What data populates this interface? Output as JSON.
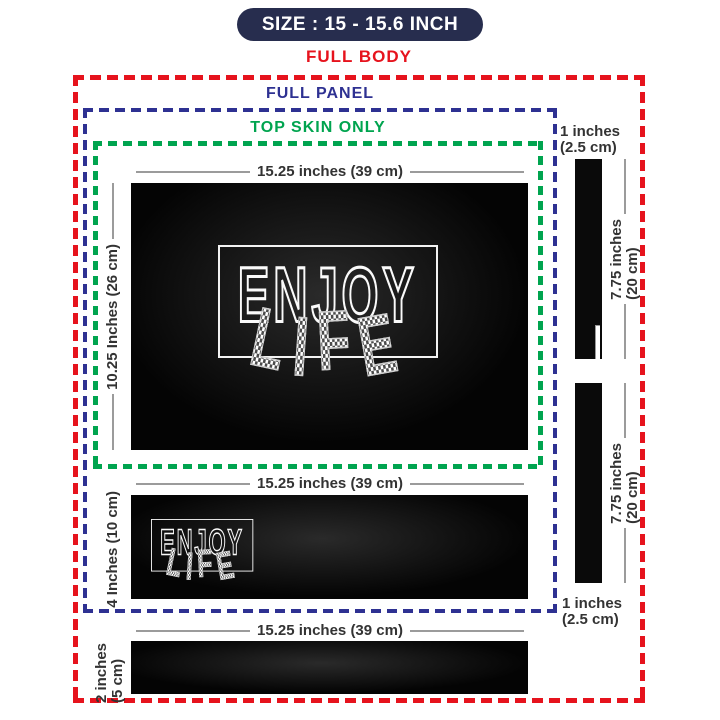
{
  "colors": {
    "navy": "#272d4e",
    "red": "#e6131d",
    "blue": "#2e3192",
    "green": "#00a44f",
    "gray": "#9b9b9b",
    "text": "#333333"
  },
  "header": {
    "size_badge": "SIZE : 15 - 15.6 INCH",
    "full_body": "FULL BODY"
  },
  "outlines": {
    "full_panel": "FULL PANEL",
    "top_skin": "TOP SKIN ONLY"
  },
  "design": {
    "word1": "ENJOY",
    "word2_letters": [
      "L",
      "I",
      "F",
      "E"
    ]
  },
  "panels": {
    "main": {
      "width_label": "15.25 inches (39 cm)",
      "height_label": "10.25 Inches (26 cm)"
    },
    "palmrest": {
      "width_label": "15.25 inches (39 cm)",
      "height_label": "4 Inches (10 cm)"
    },
    "bottom": {
      "width_label": "15.25 inches (39 cm)",
      "height_lines": [
        "2 inches",
        "(5 cm)"
      ]
    },
    "side_top": {
      "width_lines": [
        "1 inches",
        "(2.5 cm)"
      ],
      "height_lines": [
        "7.75 inches",
        "(20 cm)"
      ]
    },
    "side_bottom": {
      "width_lines": [
        "1 inches",
        "(2.5 cm)"
      ],
      "height_lines": [
        "7.75 inches",
        "(20 cm)"
      ]
    }
  }
}
